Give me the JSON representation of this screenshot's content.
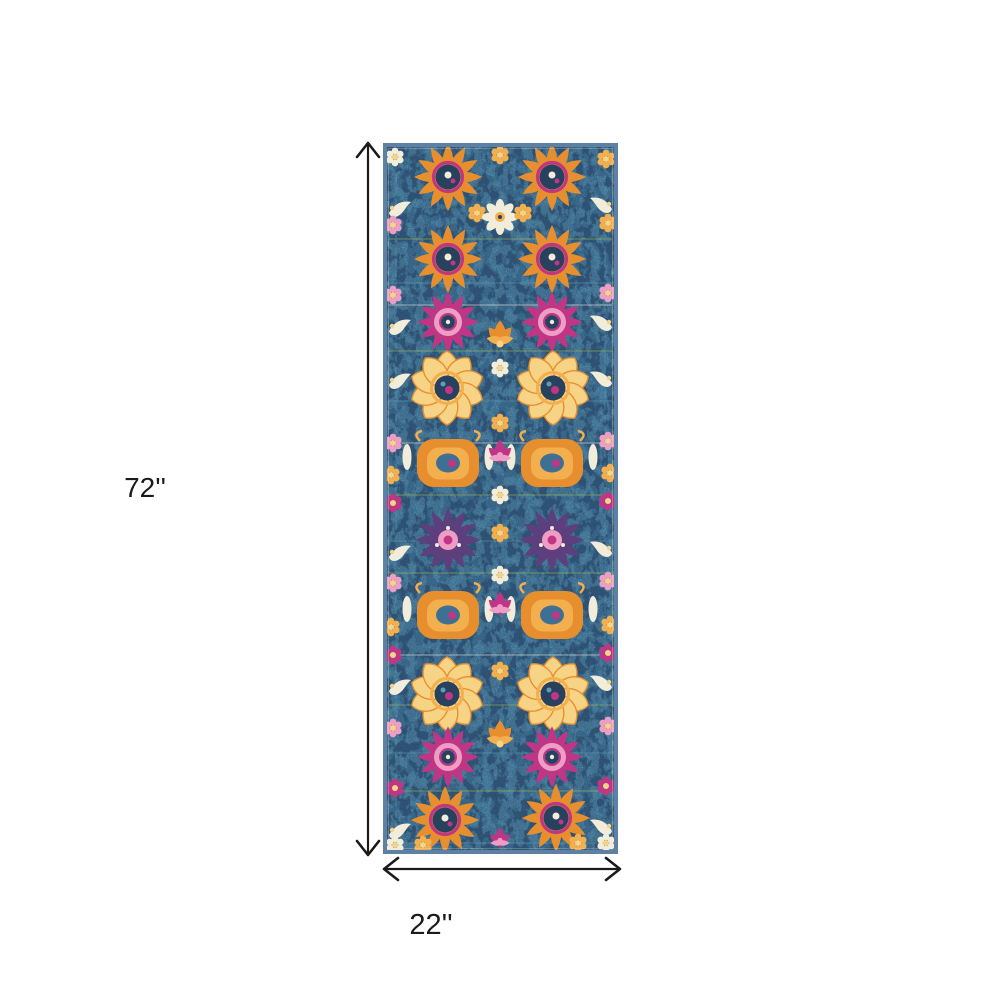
{
  "figure": {
    "height_label": "72''",
    "width_label": "22''"
  },
  "colors": {
    "canvas": "#ffffff",
    "annotation": "#1b1b1b",
    "rug_base": "#3e7093",
    "rug_dark": "#2a4768",
    "rug_light": "#5d9cba",
    "rug_border": "#5e80a2",
    "navy": "#27415f",
    "orange": "#e78f2e",
    "amber": "#f3ae4e",
    "yellow": "#f7d386",
    "cream": "#f2ecdb",
    "magenta": "#c13585",
    "pink": "#ee9ec4",
    "purple": "#5e3f7e",
    "green": "#a4bb52"
  }
}
